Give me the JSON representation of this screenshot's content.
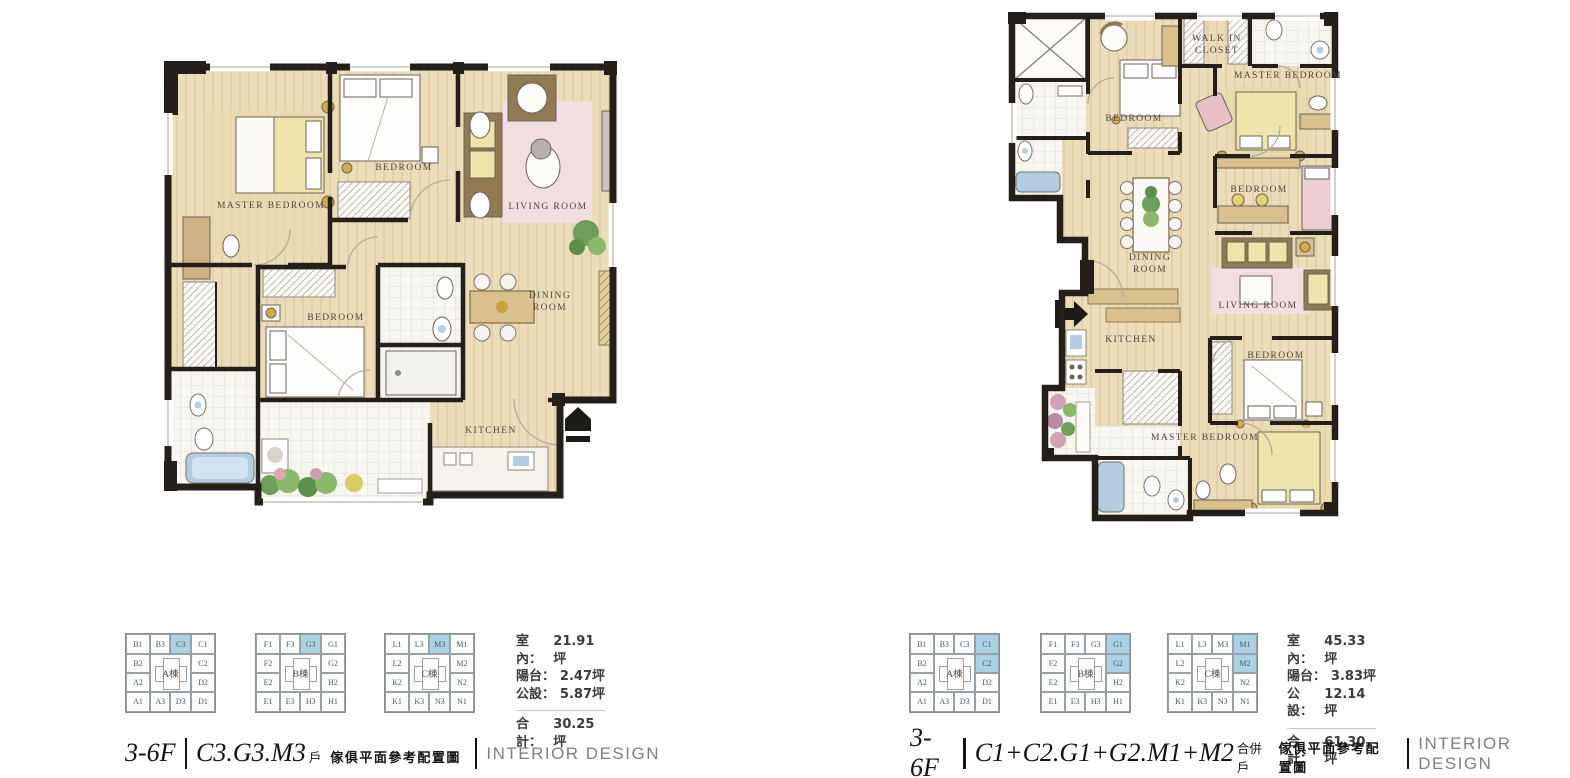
{
  "keyplan_buildings": [
    {
      "name": "A棟",
      "top": [
        "B1",
        "B3",
        "C3",
        "C1"
      ],
      "left": [
        "B2",
        "A2"
      ],
      "right": [
        "C2",
        "D2"
      ],
      "bottom": [
        "A1",
        "A3",
        "D3",
        "D1"
      ]
    },
    {
      "name": "B棟",
      "top": [
        "F1",
        "F3",
        "G3",
        "G1"
      ],
      "left": [
        "F2",
        "E2"
      ],
      "right": [
        "G2",
        "H2"
      ],
      "bottom": [
        "E1",
        "E3",
        "H3",
        "H1"
      ]
    },
    {
      "name": "C棟",
      "top": [
        "L1",
        "L3",
        "M3",
        "M1"
      ],
      "left": [
        "L2",
        "K2"
      ],
      "right": [
        "M2",
        "N2"
      ],
      "bottom": [
        "K1",
        "K3",
        "N3",
        "N1"
      ]
    }
  ],
  "colors": {
    "highlight": "#abd2e3",
    "wall": "#242019",
    "floor": "#ecddba",
    "tile": "#f7f6f0",
    "pink": "#f1dee1",
    "yellow": "#efe5ac",
    "tub_blue": "#b5cde3",
    "brand_gray": "#808080"
  },
  "left_panel": {
    "rooms": {
      "master_bedroom": "MASTER BEDROOM",
      "bedroom_top": "BEDROOM",
      "living_room": "LIVING ROOM",
      "bedroom_mid": "BEDROOM",
      "dining_room": "DINING ROOM",
      "kitchen": "KITCHEN"
    },
    "highlights": [
      "C3",
      "G3",
      "M3"
    ],
    "areas": {
      "rows": [
        {
          "label": "室內：",
          "value": "21.91坪"
        },
        {
          "label": "陽台：",
          "value": "2.47坪"
        },
        {
          "label": "公設：",
          "value": "5.87坪"
        }
      ],
      "total": {
        "label": "合計：",
        "value": "30.25坪"
      }
    },
    "title": {
      "floor": "3-6F",
      "unit": "C3.G3.M3",
      "unit_suffix": "戶",
      "subtitle": "傢俱平面參考配置圖",
      "brand": "INTERIOR DESIGN"
    }
  },
  "right_panel": {
    "rooms": {
      "bedroom_top": "BEDROOM",
      "walk_in_closet": "WALK IN CLOSET",
      "master_bedroom_top": "MASTER BEDROOM",
      "bedroom_mid": "BEDROOM",
      "dining_room": "DINING ROOM",
      "living_room": "LIVING ROOM",
      "kitchen": "KITCHEN",
      "bedroom_low": "BEDROOM",
      "master_bedroom_bottom": "MASTER BEDROOM"
    },
    "highlights": [
      "C1",
      "C2",
      "G1",
      "G2",
      "M1",
      "M2"
    ],
    "areas": {
      "rows": [
        {
          "label": "室內：",
          "value": "45.33坪"
        },
        {
          "label": "陽台：",
          "value": "3.83坪"
        },
        {
          "label": "公設：",
          "value": "12.14坪"
        }
      ],
      "total": {
        "label": "合計：",
        "value": "61.30坪"
      }
    },
    "title": {
      "floor": "3-6F",
      "unit": "C1+C2.G1+G2.M1+M2",
      "unit_suffix": "合併戶",
      "subtitle": "傢俱平面參考配置圖",
      "brand": "INTERIOR DESIGN"
    }
  }
}
